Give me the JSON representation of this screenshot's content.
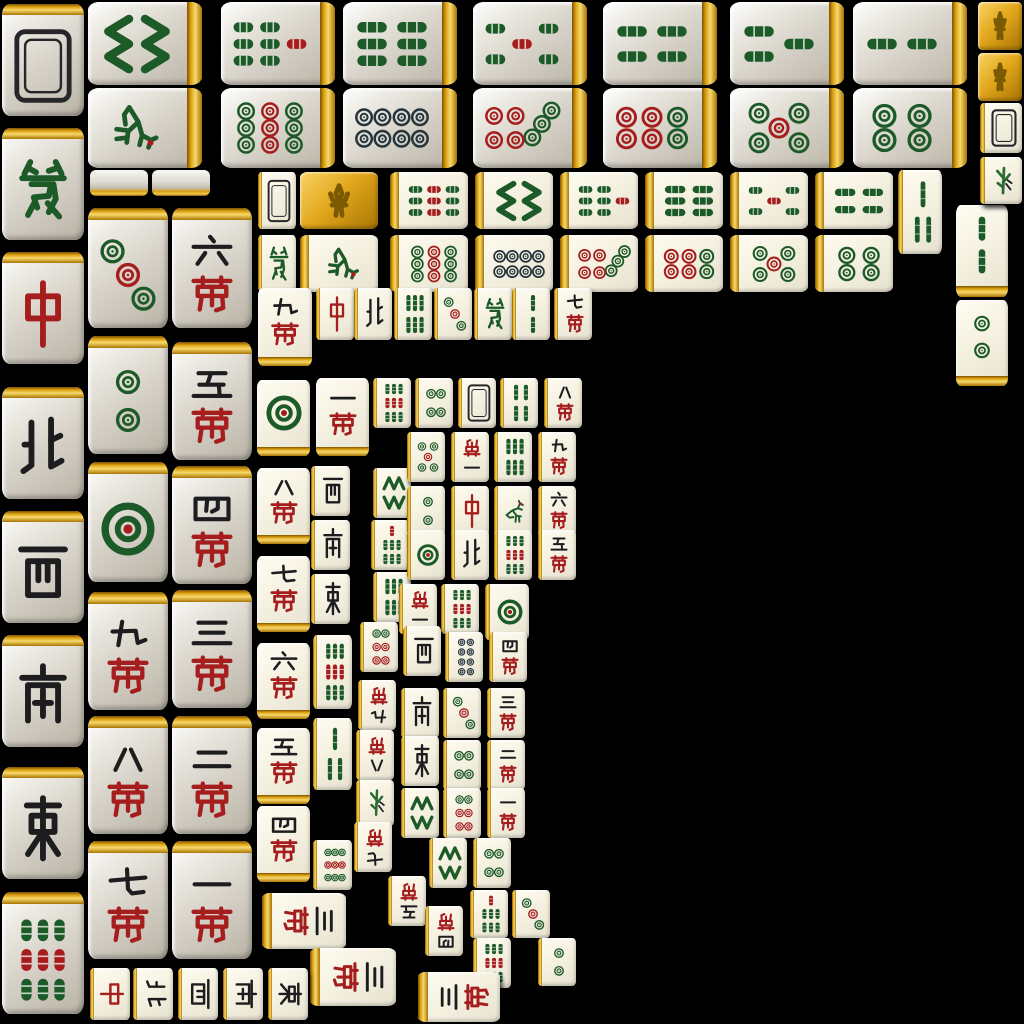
{
  "app": {
    "name": "mahjong-tile-atlas",
    "background": "#000000",
    "canvas": {
      "width": 1024,
      "height": 1024
    }
  },
  "palette": {
    "bamboo_green": "#1c5a28",
    "dot_green": "#1c5a28",
    "red": "#a51d1d",
    "ink": "#1d1d20",
    "dot8_dark": "#24343c",
    "gold_light": "#f7d96b",
    "gold_dark": "#8a5f00",
    "fleur_gold": "#7c5a02",
    "face_gray": "#d6d1c7",
    "face_ivory": "#f6f2e2"
  },
  "legend": {
    "kinds": [
      "bam",
      "dot",
      "wan",
      "wind",
      "dragon",
      "back",
      "flower",
      "plant",
      "edge"
    ],
    "winds": {
      "dong": "East",
      "nan": "South",
      "xi": "West",
      "bei": "North"
    },
    "dragons": {
      "zhong": "Red dragon",
      "fa": "Green dragon"
    },
    "tile_fields": [
      "kind",
      "value",
      "x",
      "y",
      "w",
      "h",
      "rotation"
    ]
  },
  "tiles": [
    [
      "back",
      0,
      2,
      4,
      82,
      112,
      0
    ],
    [
      "dragon",
      "fa",
      2,
      128,
      82,
      112,
      0
    ],
    [
      "dragon",
      "zhong",
      2,
      252,
      82,
      112,
      0
    ],
    [
      "wind",
      "bei",
      2,
      387,
      82,
      112,
      0
    ],
    [
      "wind",
      "xi",
      2,
      511,
      82,
      112,
      0
    ],
    [
      "wind",
      "nan",
      2,
      635,
      82,
      112,
      0
    ],
    [
      "wind",
      "dong",
      2,
      767,
      82,
      112,
      0
    ],
    [
      "bam",
      9,
      2,
      892,
      82,
      122,
      0
    ],
    [
      "dot",
      3,
      88,
      208,
      80,
      120,
      0
    ],
    [
      "dot",
      2,
      88,
      336,
      80,
      118,
      0
    ],
    [
      "dot",
      1,
      88,
      462,
      80,
      120,
      0
    ],
    [
      "wan",
      9,
      88,
      592,
      80,
      118,
      0
    ],
    [
      "wan",
      8,
      88,
      716,
      80,
      118,
      0
    ],
    [
      "wan",
      7,
      88,
      841,
      80,
      118,
      0
    ],
    [
      "wan",
      6,
      172,
      208,
      80,
      120,
      0
    ],
    [
      "wan",
      5,
      172,
      342,
      80,
      118,
      0
    ],
    [
      "wan",
      4,
      172,
      466,
      80,
      118,
      0
    ],
    [
      "wan",
      3,
      172,
      590,
      80,
      118,
      0
    ],
    [
      "wan",
      2,
      172,
      716,
      80,
      118,
      0
    ],
    [
      "wan",
      1,
      172,
      841,
      80,
      118,
      0
    ],
    [
      "bam",
      8,
      88,
      2,
      114,
      83,
      90
    ],
    [
      "bam",
      7,
      221,
      2,
      114,
      83,
      90
    ],
    [
      "bam",
      6,
      343,
      2,
      114,
      83,
      90
    ],
    [
      "bam",
      5,
      473,
      2,
      114,
      83,
      90
    ],
    [
      "bam",
      4,
      603,
      2,
      114,
      83,
      90
    ],
    [
      "bam",
      3,
      730,
      2,
      114,
      83,
      90
    ],
    [
      "bam",
      2,
      853,
      2,
      114,
      83,
      90
    ],
    [
      "bam",
      1,
      88,
      88,
      114,
      80,
      90
    ],
    [
      "dot",
      9,
      221,
      88,
      114,
      80,
      90
    ],
    [
      "dot",
      8,
      343,
      88,
      114,
      80,
      90
    ],
    [
      "dot",
      7,
      473,
      88,
      114,
      80,
      90
    ],
    [
      "dot",
      6,
      603,
      88,
      114,
      80,
      90
    ],
    [
      "dot",
      5,
      730,
      88,
      114,
      80,
      90
    ],
    [
      "dot",
      4,
      853,
      88,
      114,
      80,
      90
    ],
    [
      "edge",
      0,
      90,
      170,
      58,
      26,
      0
    ],
    [
      "edge",
      0,
      152,
      170,
      58,
      26,
      0
    ],
    [
      "back",
      0,
      258,
      172,
      38,
      57,
      0
    ],
    [
      "flower",
      0,
      300,
      172,
      78,
      57,
      0
    ],
    [
      "bam",
      9,
      390,
      172,
      78,
      57,
      90
    ],
    [
      "bam",
      8,
      475,
      172,
      78,
      57,
      90
    ],
    [
      "bam",
      7,
      560,
      172,
      78,
      57,
      90
    ],
    [
      "bam",
      6,
      645,
      172,
      78,
      57,
      90
    ],
    [
      "bam",
      5,
      730,
      172,
      78,
      57,
      90
    ],
    [
      "bam",
      4,
      815,
      172,
      78,
      57,
      90
    ],
    [
      "dragon",
      "fa",
      258,
      235,
      38,
      57,
      0
    ],
    [
      "bam",
      1,
      300,
      235,
      78,
      57,
      90
    ],
    [
      "dot",
      9,
      390,
      235,
      78,
      57,
      90
    ],
    [
      "dot",
      8,
      475,
      235,
      78,
      57,
      90
    ],
    [
      "dot",
      7,
      560,
      235,
      78,
      57,
      90
    ],
    [
      "dot",
      6,
      645,
      235,
      78,
      57,
      90
    ],
    [
      "dot",
      5,
      730,
      235,
      78,
      57,
      90
    ],
    [
      "dot",
      4,
      815,
      235,
      78,
      57,
      90
    ],
    [
      "bam",
      3,
      898,
      170,
      44,
      84,
      0
    ],
    [
      "bam",
      2,
      956,
      205,
      52,
      92,
      0
    ],
    [
      "dot",
      2,
      956,
      300,
      52,
      86,
      0
    ],
    [
      "flower",
      0,
      978,
      2,
      44,
      48,
      0
    ],
    [
      "flower",
      0,
      978,
      53,
      44,
      48,
      0
    ],
    [
      "back",
      0,
      980,
      103,
      42,
      50,
      0
    ],
    [
      "plant",
      0,
      980,
      157,
      42,
      47,
      0
    ],
    [
      "wan",
      9,
      258,
      288,
      54,
      78,
      0
    ],
    [
      "dragon",
      "zhong",
      316,
      288,
      38,
      52,
      0
    ],
    [
      "wind",
      "bei",
      354,
      288,
      38,
      52,
      0
    ],
    [
      "bam",
      6,
      394,
      288,
      38,
      52,
      0
    ],
    [
      "dot",
      3,
      434,
      288,
      38,
      52,
      0
    ],
    [
      "dragon",
      "fa",
      474,
      288,
      38,
      52,
      0
    ],
    [
      "bam",
      2,
      512,
      288,
      38,
      52,
      0
    ],
    [
      "wan",
      7,
      554,
      288,
      38,
      52,
      0
    ],
    [
      "dot",
      1,
      257,
      380,
      53,
      76,
      0
    ],
    [
      "wan",
      8,
      257,
      468,
      53,
      76,
      0
    ],
    [
      "wan",
      7,
      257,
      556,
      53,
      76,
      0
    ],
    [
      "wan",
      6,
      257,
      643,
      53,
      76,
      0
    ],
    [
      "wan",
      5,
      257,
      728,
      53,
      76,
      0
    ],
    [
      "wan",
      4,
      257,
      806,
      53,
      76,
      0
    ],
    [
      "wan",
      1,
      316,
      378,
      53,
      78,
      0
    ],
    [
      "wind",
      "xi",
      311,
      466,
      39,
      50,
      0
    ],
    [
      "wind",
      "nan",
      311,
      520,
      39,
      50,
      0
    ],
    [
      "wind",
      "dong",
      311,
      574,
      39,
      50,
      0
    ],
    [
      "bam",
      9,
      313,
      635,
      39,
      74,
      0
    ],
    [
      "bam",
      3,
      313,
      718,
      39,
      72,
      0
    ],
    [
      "dot",
      9,
      313,
      840,
      39,
      50,
      0
    ],
    [
      "bam",
      9,
      373,
      378,
      38,
      50,
      0
    ],
    [
      "bam",
      8,
      373,
      468,
      38,
      50,
      0
    ],
    [
      "bam",
      7,
      371,
      520,
      38,
      50,
      0
    ],
    [
      "bam",
      6,
      373,
      572,
      38,
      50,
      0
    ],
    [
      "dot",
      6,
      360,
      622,
      38,
      50,
      0
    ],
    [
      "wan",
      9,
      358,
      680,
      38,
      50,
      180
    ],
    [
      "wan",
      8,
      356,
      730,
      38,
      50,
      180
    ],
    [
      "plant",
      0,
      356,
      780,
      38,
      46,
      0
    ],
    [
      "wan",
      7,
      354,
      822,
      38,
      50,
      180
    ],
    [
      "dot",
      4,
      415,
      378,
      38,
      50,
      0
    ],
    [
      "back",
      0,
      458,
      378,
      38,
      50,
      0
    ],
    [
      "bam",
      4,
      500,
      378,
      38,
      50,
      0
    ],
    [
      "wan",
      8,
      544,
      378,
      38,
      50,
      0
    ],
    [
      "dot",
      5,
      407,
      432,
      38,
      50,
      0
    ],
    [
      "wan",
      1,
      451,
      432,
      38,
      50,
      180
    ],
    [
      "bam",
      6,
      494,
      432,
      38,
      50,
      0
    ],
    [
      "wan",
      9,
      538,
      432,
      38,
      50,
      0
    ],
    [
      "dot",
      2,
      407,
      486,
      38,
      50,
      0
    ],
    [
      "dragon",
      "zhong",
      451,
      486,
      38,
      50,
      0
    ],
    [
      "bam",
      1,
      494,
      486,
      38,
      50,
      0
    ],
    [
      "wan",
      6,
      538,
      486,
      38,
      50,
      0
    ],
    [
      "dot",
      1,
      407,
      530,
      38,
      50,
      0
    ],
    [
      "wind",
      "bei",
      451,
      530,
      38,
      50,
      0
    ],
    [
      "bam",
      9,
      494,
      530,
      38,
      50,
      0
    ],
    [
      "wan",
      5,
      538,
      530,
      38,
      50,
      0
    ],
    [
      "wan",
      1,
      399,
      584,
      38,
      50,
      180
    ],
    [
      "bam",
      9,
      441,
      584,
      38,
      50,
      0
    ],
    [
      "dot",
      1,
      485,
      584,
      44,
      56,
      0
    ],
    [
      "wind",
      "xi",
      403,
      626,
      38,
      50,
      0
    ],
    [
      "dot",
      8,
      445,
      632,
      38,
      50,
      0
    ],
    [
      "wan",
      4,
      489,
      632,
      38,
      50,
      0
    ],
    [
      "wind",
      "nan",
      401,
      688,
      38,
      50,
      0
    ],
    [
      "dot",
      3,
      443,
      688,
      38,
      50,
      0
    ],
    [
      "wan",
      3,
      487,
      688,
      38,
      50,
      0
    ],
    [
      "wind",
      "dong",
      401,
      736,
      38,
      50,
      0
    ],
    [
      "dot",
      4,
      443,
      740,
      38,
      50,
      0
    ],
    [
      "wan",
      2,
      487,
      740,
      38,
      50,
      0
    ],
    [
      "bam",
      8,
      401,
      788,
      38,
      50,
      0
    ],
    [
      "dot",
      6,
      443,
      788,
      38,
      50,
      0
    ],
    [
      "wan",
      1,
      487,
      788,
      38,
      50,
      0
    ],
    [
      "bam",
      8,
      429,
      838,
      38,
      50,
      0
    ],
    [
      "dot",
      4,
      473,
      838,
      38,
      50,
      0
    ],
    [
      "wan",
      5,
      388,
      876,
      38,
      50,
      180
    ],
    [
      "wan",
      4,
      425,
      906,
      38,
      50,
      180
    ],
    [
      "bam",
      7,
      470,
      890,
      38,
      48,
      0
    ],
    [
      "dot",
      3,
      512,
      890,
      38,
      48,
      0
    ],
    [
      "bam",
      9,
      473,
      938,
      38,
      50,
      0
    ],
    [
      "dot",
      2,
      538,
      938,
      38,
      48,
      0
    ],
    [
      "wan",
      3,
      262,
      893,
      84,
      56,
      90
    ],
    [
      "wan",
      3,
      310,
      948,
      86,
      58,
      90
    ],
    [
      "wan",
      3,
      418,
      972,
      82,
      50,
      270
    ],
    [
      "dragon",
      "zhong",
      90,
      968,
      40,
      52,
      90
    ],
    [
      "wind",
      "bei",
      133,
      968,
      40,
      52,
      90
    ],
    [
      "wind",
      "xi",
      178,
      968,
      40,
      52,
      90
    ],
    [
      "wind",
      "nan",
      223,
      968,
      40,
      52,
      90
    ],
    [
      "wind",
      "dong",
      268,
      968,
      40,
      52,
      90
    ]
  ]
}
